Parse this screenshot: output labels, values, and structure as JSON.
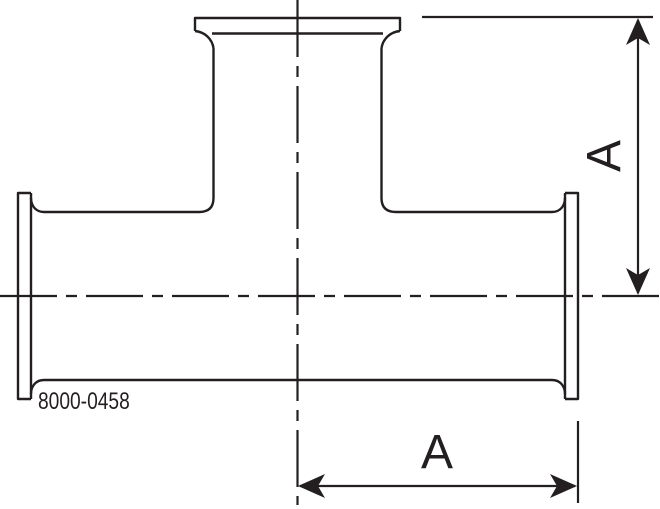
{
  "drawing": {
    "part_number": "8000-0458",
    "dimensions": {
      "vertical": {
        "label": "A"
      },
      "horizontal": {
        "label": "A"
      }
    },
    "colors": {
      "line": "#231f20",
      "background": "#ffffff"
    }
  }
}
